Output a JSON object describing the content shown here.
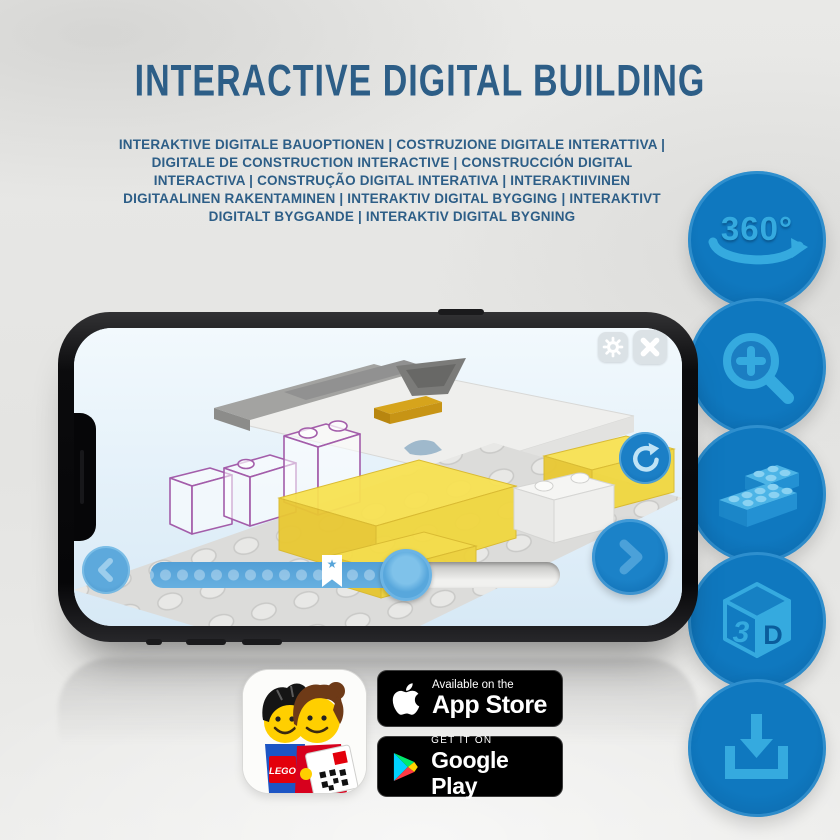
{
  "header": {
    "title": "INTERACTIVE DIGITAL BUILDING",
    "translations": "INTERAKTIVE DIGITALE BAUOPTIONEN | COSTRUZIONE DIGITALE INTERATTIVA | DIGITALE DE CONSTRUCTION INTERACTIVE | CONSTRUCCIÓN DIGITAL INTERACTIVA | CONSTRUÇÃO DIGITAL INTERATIVA | INTERAKTIIVINEN DIGITAALINEN RAKENTAMINEN | INTERAKTIV DIGITAL BYGGING | INTERAKTIVT DIGITALT BYGGANDE | INTERAKTIV DIGITAL BYGNING"
  },
  "feature_buttons": [
    {
      "name": "rotate-360",
      "icon": "360-rotation-icon",
      "label": "360°"
    },
    {
      "name": "zoom-in",
      "icon": "zoom-in-magnifier-icon"
    },
    {
      "name": "brick-building",
      "icon": "lego-bricks-icon"
    },
    {
      "name": "view-3d",
      "icon": "3d-cube-icon",
      "label_left": "3",
      "label_right": "D"
    },
    {
      "name": "download",
      "icon": "download-icon"
    }
  ],
  "phone": {
    "app": {
      "toolbar_buttons": [
        "settings",
        "close"
      ],
      "side_buttons": [
        "rotate-view",
        "previous-step",
        "next-step"
      ],
      "progress": {
        "track_percent_filled": 62,
        "bookmark_percent": 42,
        "bookmark_star": "★",
        "dot_count": 15
      }
    }
  },
  "store_badges": {
    "app_icon_label": "LEGO",
    "app_store": {
      "tagline": "Available on the",
      "store": "App Store"
    },
    "google_play": {
      "tagline": "GET IT ON",
      "store": "Google Play"
    }
  },
  "colors": {
    "title_blue": "#2d5e87",
    "button_circle_blue": "#0d6fb8",
    "icon_light_blue": "#35aadf",
    "progress_blue": "#58a5da",
    "brick_yellow": "#f6df4a",
    "screen_sky": "#e3f1fa",
    "phone_black": "#0a0a0c",
    "badge_black": "#000000"
  }
}
